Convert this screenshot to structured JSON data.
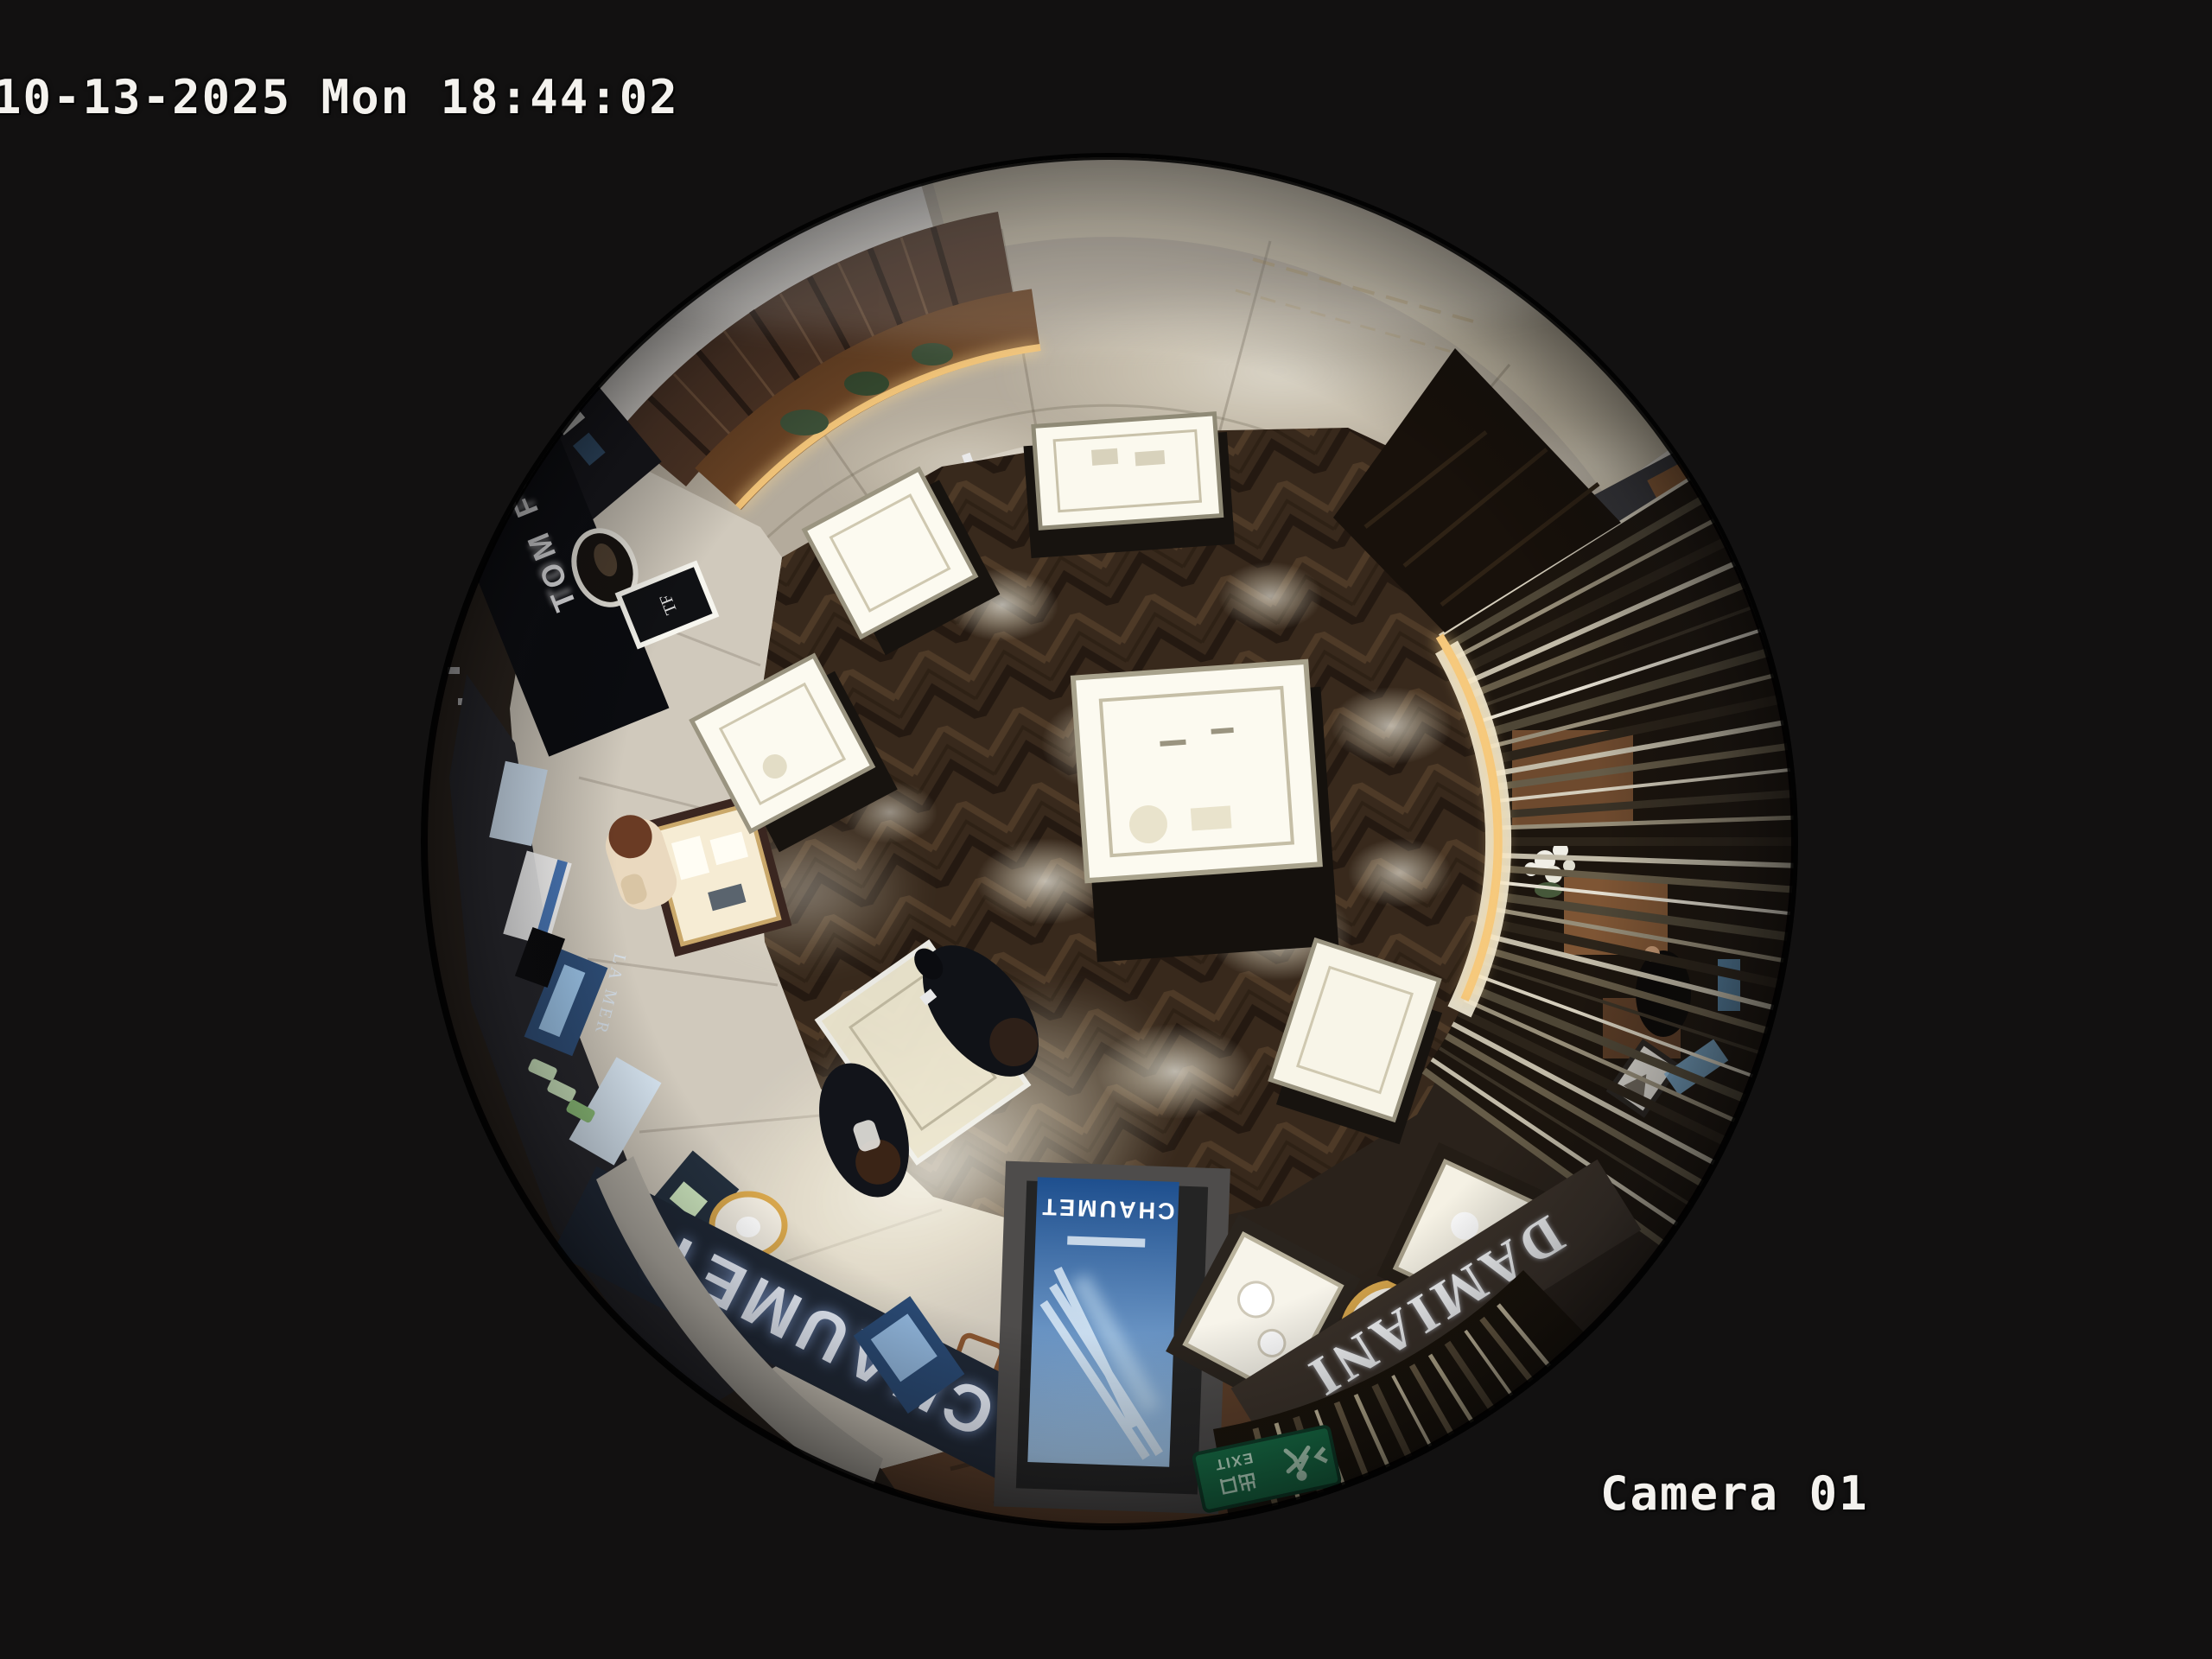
{
  "osd": {
    "timestamp": "10-13-2025 Mon 18:44:02",
    "camera_label": "Camera 01"
  },
  "signs": {
    "chaumet": "CHAUMET",
    "chaumet_small": "CHAUMET",
    "damiani": "DAMIANI",
    "damiani_small": "DAMIANI",
    "tom_ford": "TOM FORD",
    "tf_monogram": "TF",
    "exit_cn": "出口",
    "exit_en": "EXIT",
    "screen_brand": "CHAUMET",
    "la_mer": "LA MER"
  },
  "colors": {
    "background": "#121111",
    "osd_text": "#f4f2ee",
    "chaumet_fascia": "#1f2836",
    "damiani_fascia": "#3b322a",
    "exit_green": "#157247",
    "screen_blue_top": "#a8cdf0",
    "screen_blue_bottom": "#1e4f8e",
    "led_warm": "#f2c173",
    "marble_floor": "#b4ab9c",
    "walkway_stone": "#d0c9bc",
    "wood_floor": "#38291c"
  }
}
